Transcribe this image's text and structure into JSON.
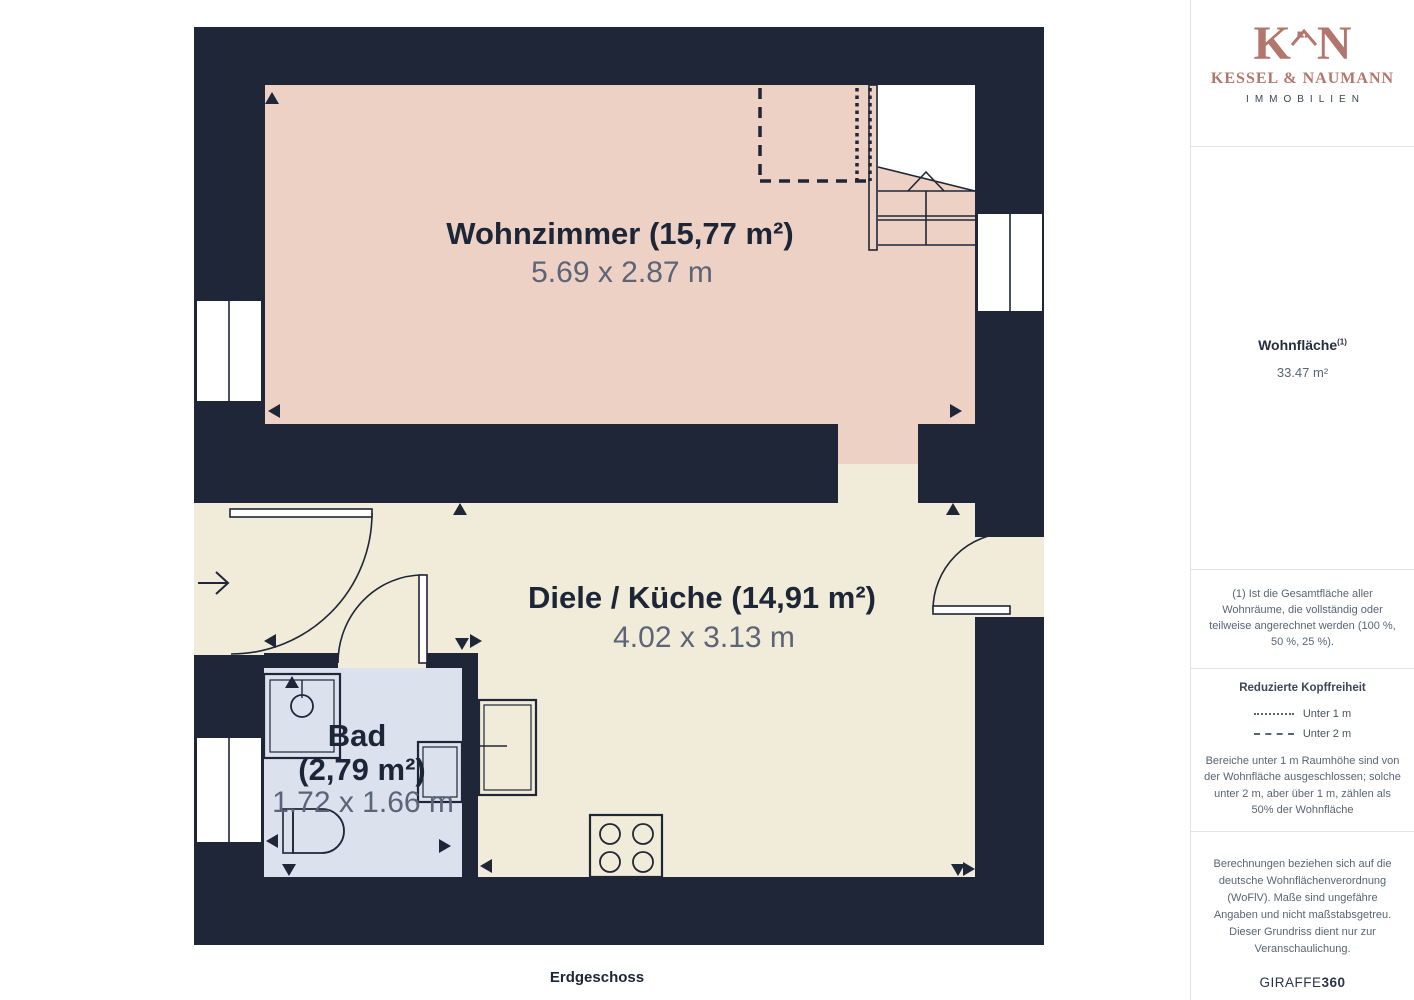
{
  "plan": {
    "floor_label": "Erdgeschoss",
    "rooms": {
      "wohnzimmer": {
        "title": "Wohnzimmer (15,77 m²)",
        "dims": "5.69 x 2.87 m",
        "color": "#eed1c5"
      },
      "diele": {
        "title": "Diele / Küche (14,91 m²)",
        "dims": "4.02 x 3.13 m",
        "color": "#f1ecd9"
      },
      "bad": {
        "title_line1": "Bad",
        "title_line2": "(2,79 m²)",
        "dims": "1.72 x 1.66 m",
        "color": "#dce1ee"
      }
    },
    "colors": {
      "wall": "#1e2637",
      "dims_text": "#5b6577",
      "title_text": "#1d2636"
    },
    "icons": {
      "entrance": "arrow-right-icon",
      "stairs_direction": "chevron-up-icon"
    }
  },
  "sidebar": {
    "logo": {
      "monogram_left": "K",
      "monogram_right": "N",
      "name": "KESSEL & NAUMANN",
      "tagline": "IMMOBILIEN",
      "accent_color": "#b3766c"
    },
    "area": {
      "label": "Wohnfläche",
      "label_sup": "(1)",
      "value": "33.47 m²"
    },
    "footnote": "(1) Ist die Gesamtfläche aller Wohnräume, die vollständig oder teilweise angerechnet werden (100 %, 50 %, 25 %).",
    "headroom": {
      "title": "Reduzierte Kopffreiheit",
      "legend": [
        {
          "style": "dotted",
          "label": "Unter 1 m"
        },
        {
          "style": "dashed",
          "label": "Unter 2 m"
        }
      ],
      "note": "Bereiche unter 1 m Raumhöhe sind von der Wohnfläche ausgeschlossen; solche unter 2 m, aber über 1 m, zählen als 50% der Wohnfläche"
    },
    "disclaimer": "Berechnungen beziehen sich auf die deutsche Wohnflächenverordnung (WoFlV). Maße sind ungefähre Angaben und nicht maßstabsgetreu. Dieser Grundriss dient nur zur Veranschaulichung.",
    "brand": {
      "left": "GIRAFFE",
      "right": "360"
    }
  }
}
